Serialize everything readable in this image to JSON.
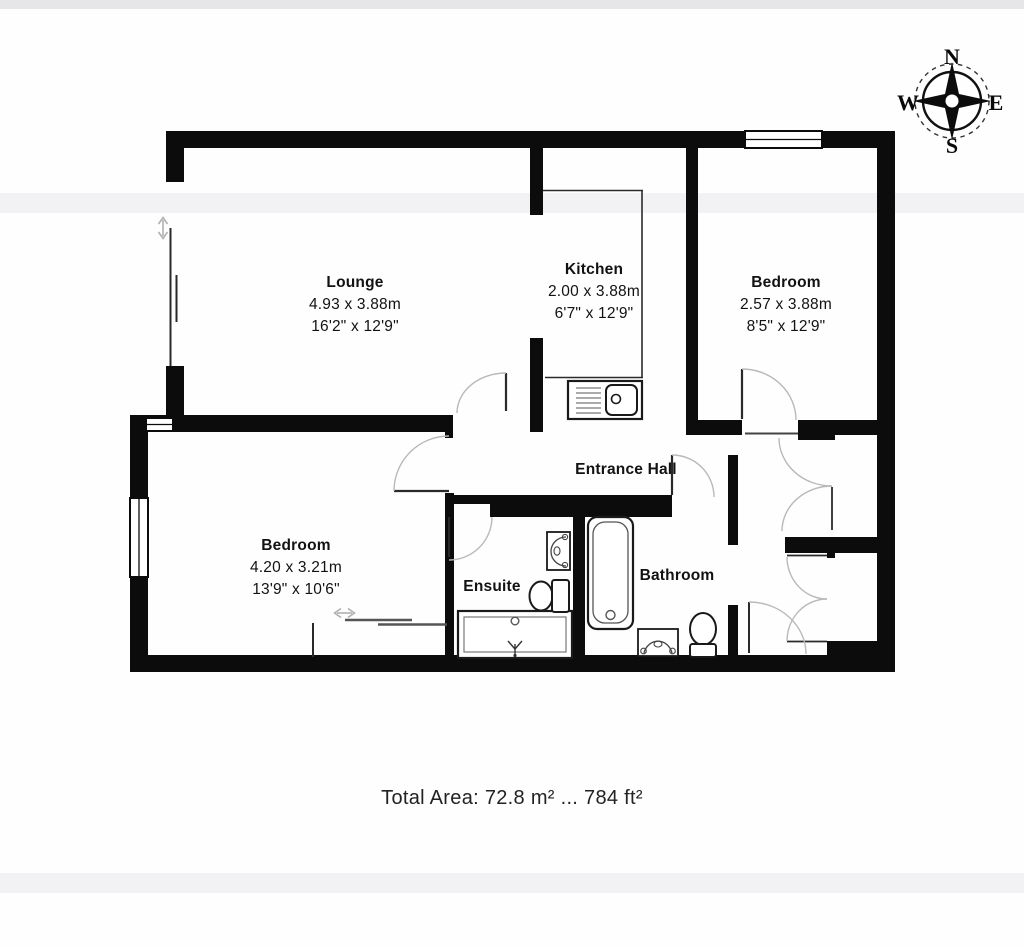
{
  "labels": {
    "lounge": {
      "name": "Lounge",
      "metric": "4.93 x 3.88m",
      "imperial": "16'2\" x 12'9\""
    },
    "kitchen": {
      "name": "Kitchen",
      "metric": "2.00 x 3.88m",
      "imperial": "6'7\" x 12'9\""
    },
    "bedroom_top": {
      "name": "Bedroom",
      "metric": "2.57 x 3.88m",
      "imperial": "8'5\" x 12'9\""
    },
    "entrance_hall": {
      "name": "Entrance Hall"
    },
    "bedroom_left": {
      "name": "Bedroom",
      "metric": "4.20 x 3.21m",
      "imperial": "13'9\" x 10'6\""
    },
    "ensuite": {
      "name": "Ensuite"
    },
    "bathroom": {
      "name": "Bathroom"
    }
  },
  "compass": {
    "north": "N",
    "south": "S",
    "east": "E",
    "west": "W"
  },
  "footer": {
    "total_area": "Total Area: 72.8 m² ... 784 ft²"
  },
  "colors": {
    "wall": "#0c0c0c",
    "line": "#2a2a2a",
    "arc": "#b9b9b9",
    "band": "#f2f2f4"
  }
}
